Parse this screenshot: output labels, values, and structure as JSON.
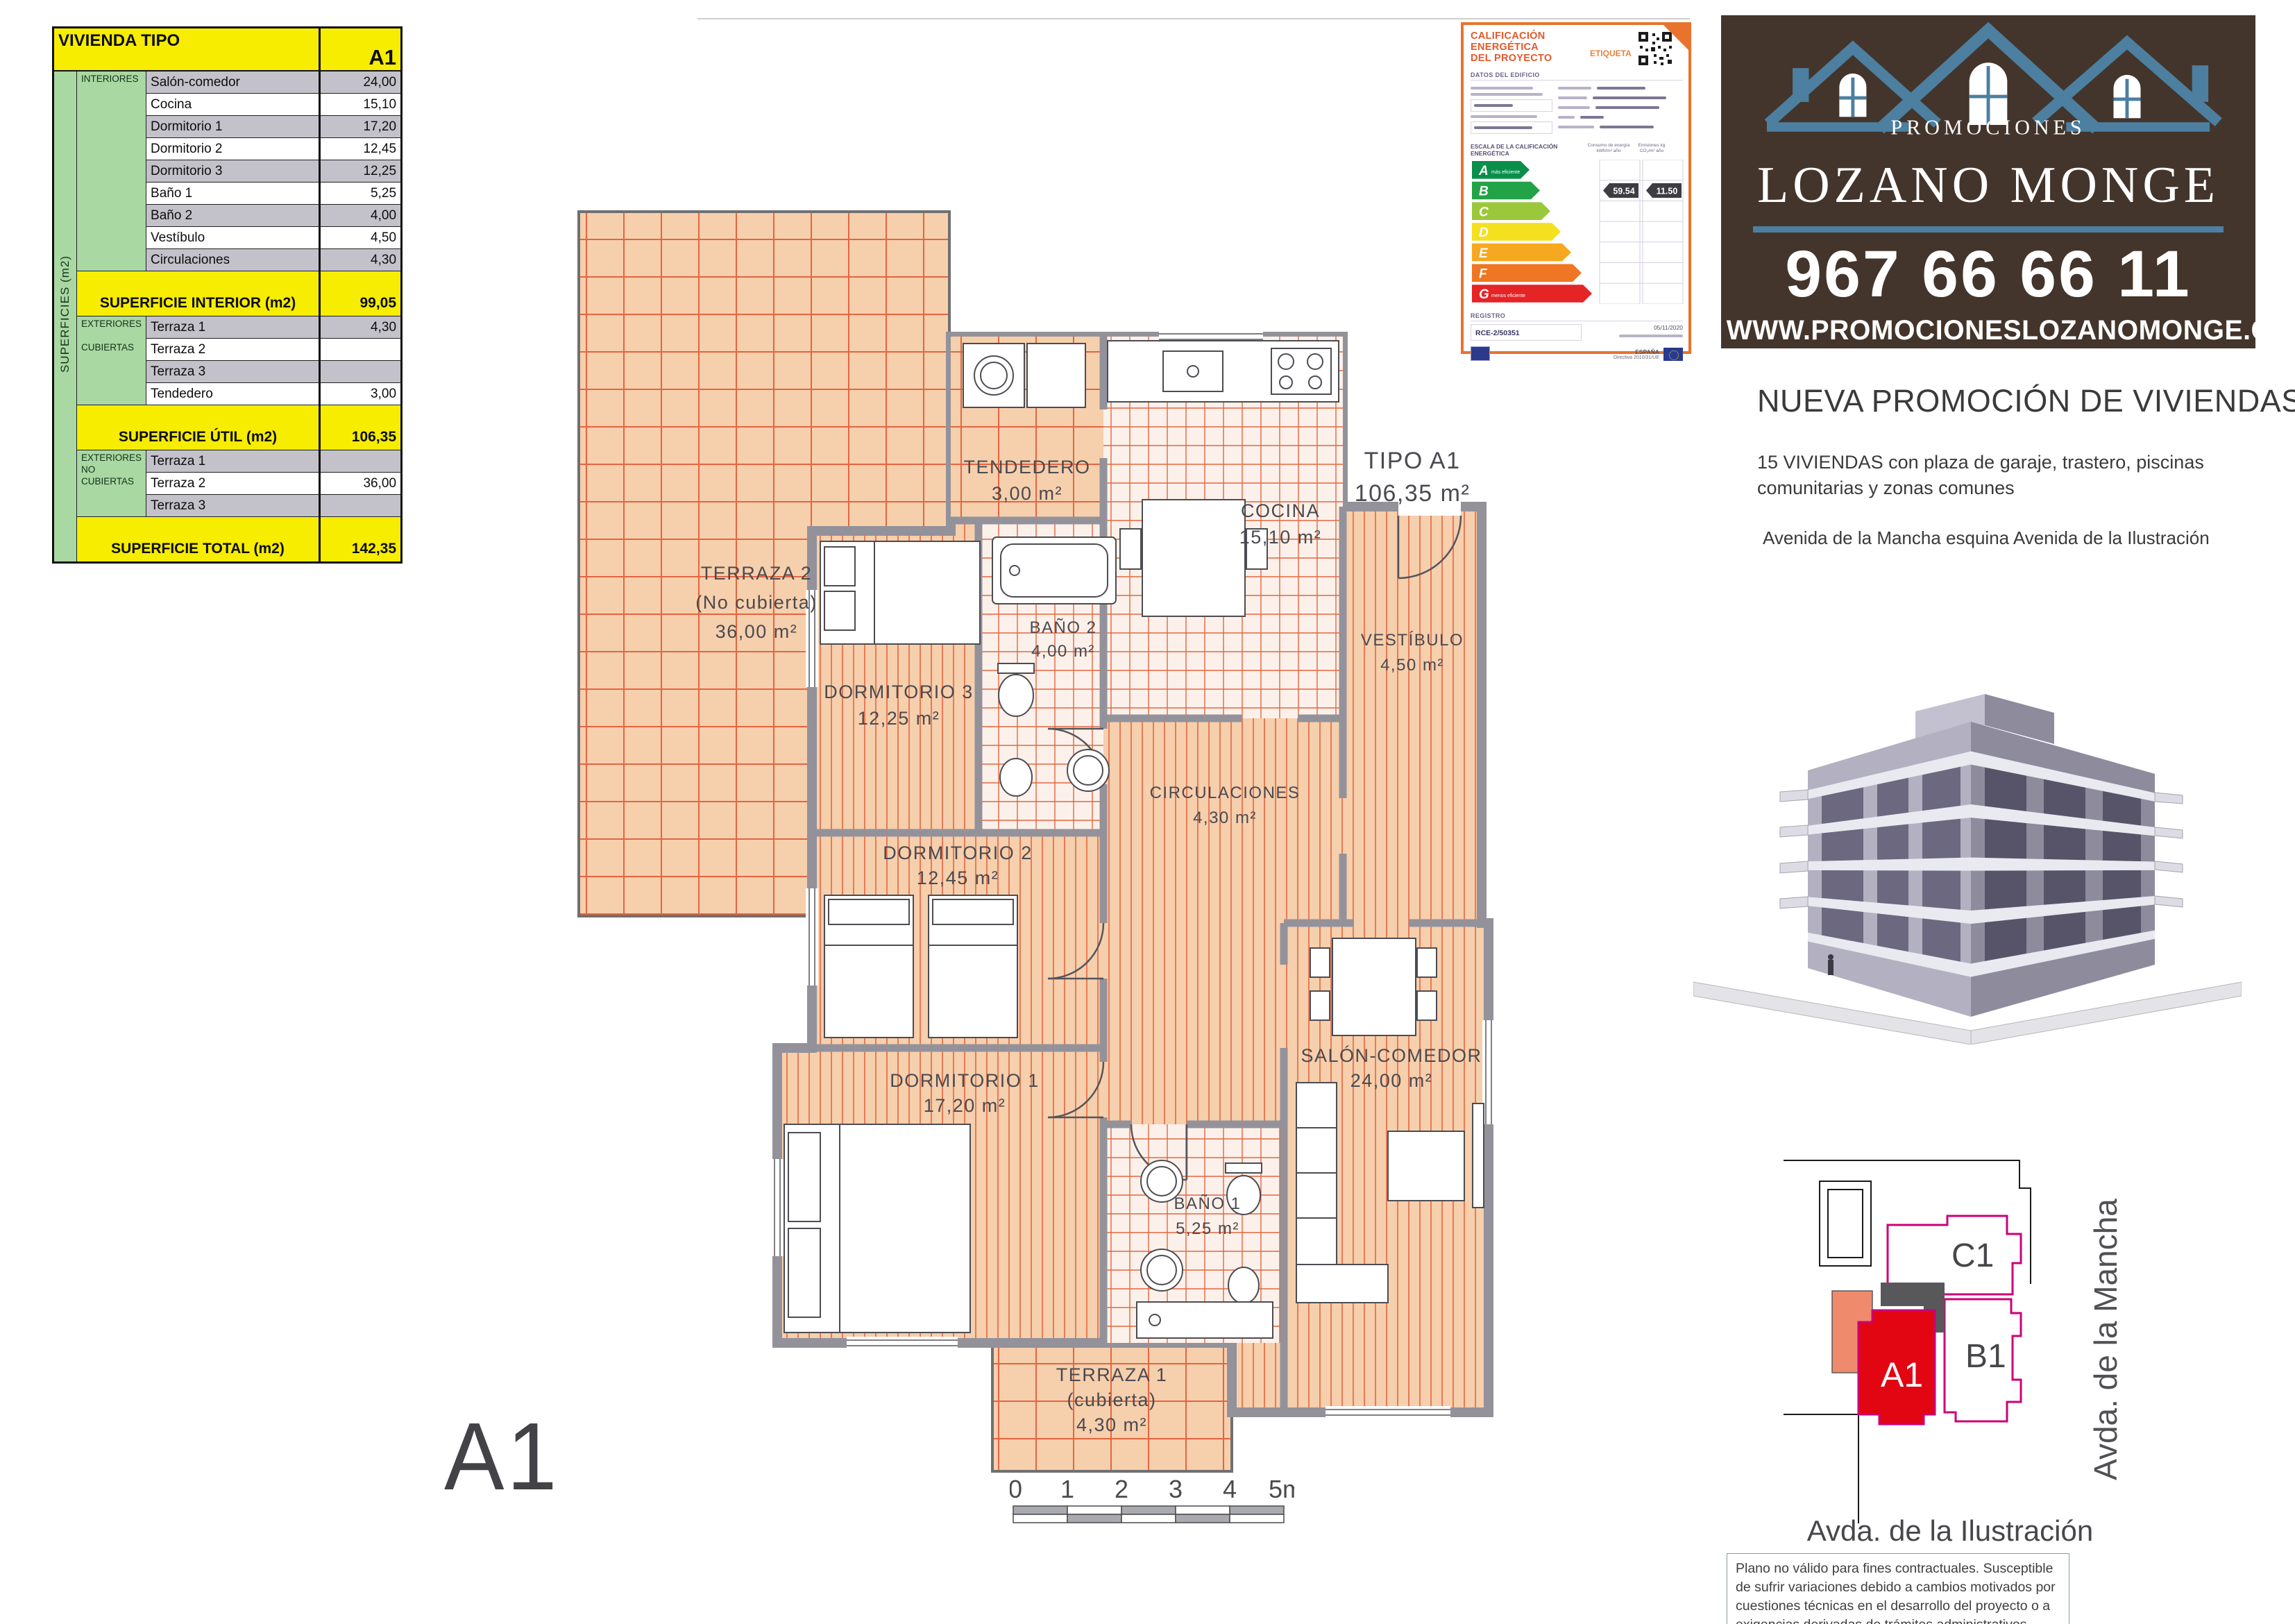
{
  "table": {
    "title": "VIVIENDA TIPO",
    "unit_type": "A1",
    "side_label": "SUPERFICIES (m2)",
    "group_interiores": "INTERIORES",
    "group_ext_cub": [
      "EXTERIORES",
      "CUBIERTAS"
    ],
    "group_ext_nocub": [
      "EXTERIORES",
      "NO",
      "CUBIERTAS"
    ],
    "interiores": [
      {
        "label": "Salón-comedor",
        "value": "24,00"
      },
      {
        "label": "Cocina",
        "value": "15,10"
      },
      {
        "label": "Dormitorio 1",
        "value": "17,20"
      },
      {
        "label": "Dormitorio 2",
        "value": "12,45"
      },
      {
        "label": "Dormitorio 3",
        "value": "12,25"
      },
      {
        "label": "Baño 1",
        "value": "5,25"
      },
      {
        "label": "Baño 2",
        "value": "4,00"
      },
      {
        "label": "Vestíbulo",
        "value": "4,50"
      },
      {
        "label": "Circulaciones",
        "value": "4,30"
      }
    ],
    "ext_cubiertas": [
      {
        "label": "Terraza 1",
        "value": "4,30"
      },
      {
        "label": "Terraza 2",
        "value": ""
      },
      {
        "label": "Terraza 3",
        "value": ""
      },
      {
        "label": "Tendedero",
        "value": "3,00"
      }
    ],
    "ext_no_cubiertas": [
      {
        "label": "Terraza 1",
        "value": ""
      },
      {
        "label": "Terraza 2",
        "value": "36,00"
      },
      {
        "label": "Terraza 3",
        "value": ""
      }
    ],
    "totals": {
      "interior": {
        "label": "SUPERFICIE  INTERIOR (m2)",
        "value": "99,05"
      },
      "util": {
        "label": "SUPERFICIE  ÚTIL (m2)",
        "value": "106,35"
      },
      "total": {
        "label": "SUPERFICIE  TOTAL (m2)",
        "value": "142,35"
      }
    }
  },
  "plan": {
    "rooms": {
      "terraza2": [
        "TERRAZA 2",
        "(No cubierta)",
        "36,00 m²"
      ],
      "tendedero": [
        "TENDEDERO",
        "3,00 m²"
      ],
      "cocina": [
        "COCINA",
        "15,10 m²"
      ],
      "bano2": [
        "BAÑO 2",
        "4,00 m²"
      ],
      "vestibulo": [
        "VESTÍBULO",
        "4,50 m²"
      ],
      "circulaciones": [
        "CIRCULACIONES",
        "4,30 m²"
      ],
      "dormitorio3": [
        "DORMITORIO 3",
        "12,25 m²"
      ],
      "dormitorio2": [
        "DORMITORIO 2",
        "12,45 m²"
      ],
      "dormitorio1": [
        "DORMITORIO 1",
        "17,20 m²"
      ],
      "bano1": [
        "BAÑO 1",
        "5,25 m²"
      ],
      "salon": [
        "SALÓN-COMEDOR",
        "24,00 m²"
      ],
      "terraza1": [
        "TERRAZA 1",
        "(cubierta)",
        "4,30 m²"
      ],
      "tipo": [
        "TIPO A1",
        "106,35 m²"
      ]
    },
    "big_label": "A1",
    "scale_ticks": [
      "0",
      "1",
      "2",
      "3",
      "4",
      "5m"
    ]
  },
  "energy": {
    "title_line1": "CALIFICACIÓN ENERGÉTICA",
    "title_line2": "DEL PROYECTO",
    "etiqueta": "ETIQUETA",
    "datos_header": "DATOS DEL EDIFICIO",
    "escala_header": "ESCALA DE LA CALIFICACIÓN ENERGÉTICA",
    "col1_header": "Consumo de energía kWh/m² año",
    "col2_header": "Emisiones kg CO₂/m² año",
    "scale": [
      {
        "letter": "A",
        "note": "más eficiente",
        "color": "#0a8f4a"
      },
      {
        "letter": "B",
        "note": "",
        "color": "#22a347"
      },
      {
        "letter": "C",
        "note": "",
        "color": "#9bc83a"
      },
      {
        "letter": "D",
        "note": "",
        "color": "#f4e01f"
      },
      {
        "letter": "E",
        "note": "",
        "color": "#f6a821"
      },
      {
        "letter": "F",
        "note": "",
        "color": "#ef7623"
      },
      {
        "letter": "G",
        "note": "menos eficiente",
        "color": "#e52426"
      }
    ],
    "consumo_value": "59.54",
    "emisiones_value": "11.50",
    "registro_header": "REGISTRO",
    "registro_value": "RCE-2/50351",
    "date": "05/11/2020",
    "country": "ESPAÑA",
    "directive": "Directiva 2010/31/UE"
  },
  "banner": {
    "promociones": "PROMOCIONES",
    "name": "LOZANO MONGE",
    "phone": "967 66 66 11",
    "website": "WWW.PROMOCIONESLOZANOMONGE.COM",
    "roof_color": "#4c7fa0"
  },
  "promo": {
    "heading": "NUEVA PROMOCIÓN DE VIVIENDAS",
    "body_line1": "15 VIVIENDAS con plaza de garaje, trastero, piscinas",
    "body_line2": "comunitarias y zonas comunes",
    "address": "Avenida de la Mancha esquina Avenida de la Ilustración"
  },
  "siteplan": {
    "units": {
      "a1": "A1",
      "b1": "B1",
      "c1": "C1"
    },
    "street_right": "Avda. de la Mancha",
    "street_bottom": "Avda. de la Ilustración",
    "accent_magenta": "#cc0077",
    "unit_red": "#e20613",
    "salmon": "#ef8a6d"
  },
  "disclaimer": {
    "line1": "Plano no válido para fines contractuales. Susceptible de sufrir variaciones debido a cambios motivados por cuestiones",
    "line2": "técnicas en el desarrollo del proyecto o a exigencias derivadas de trámites administrativos"
  }
}
